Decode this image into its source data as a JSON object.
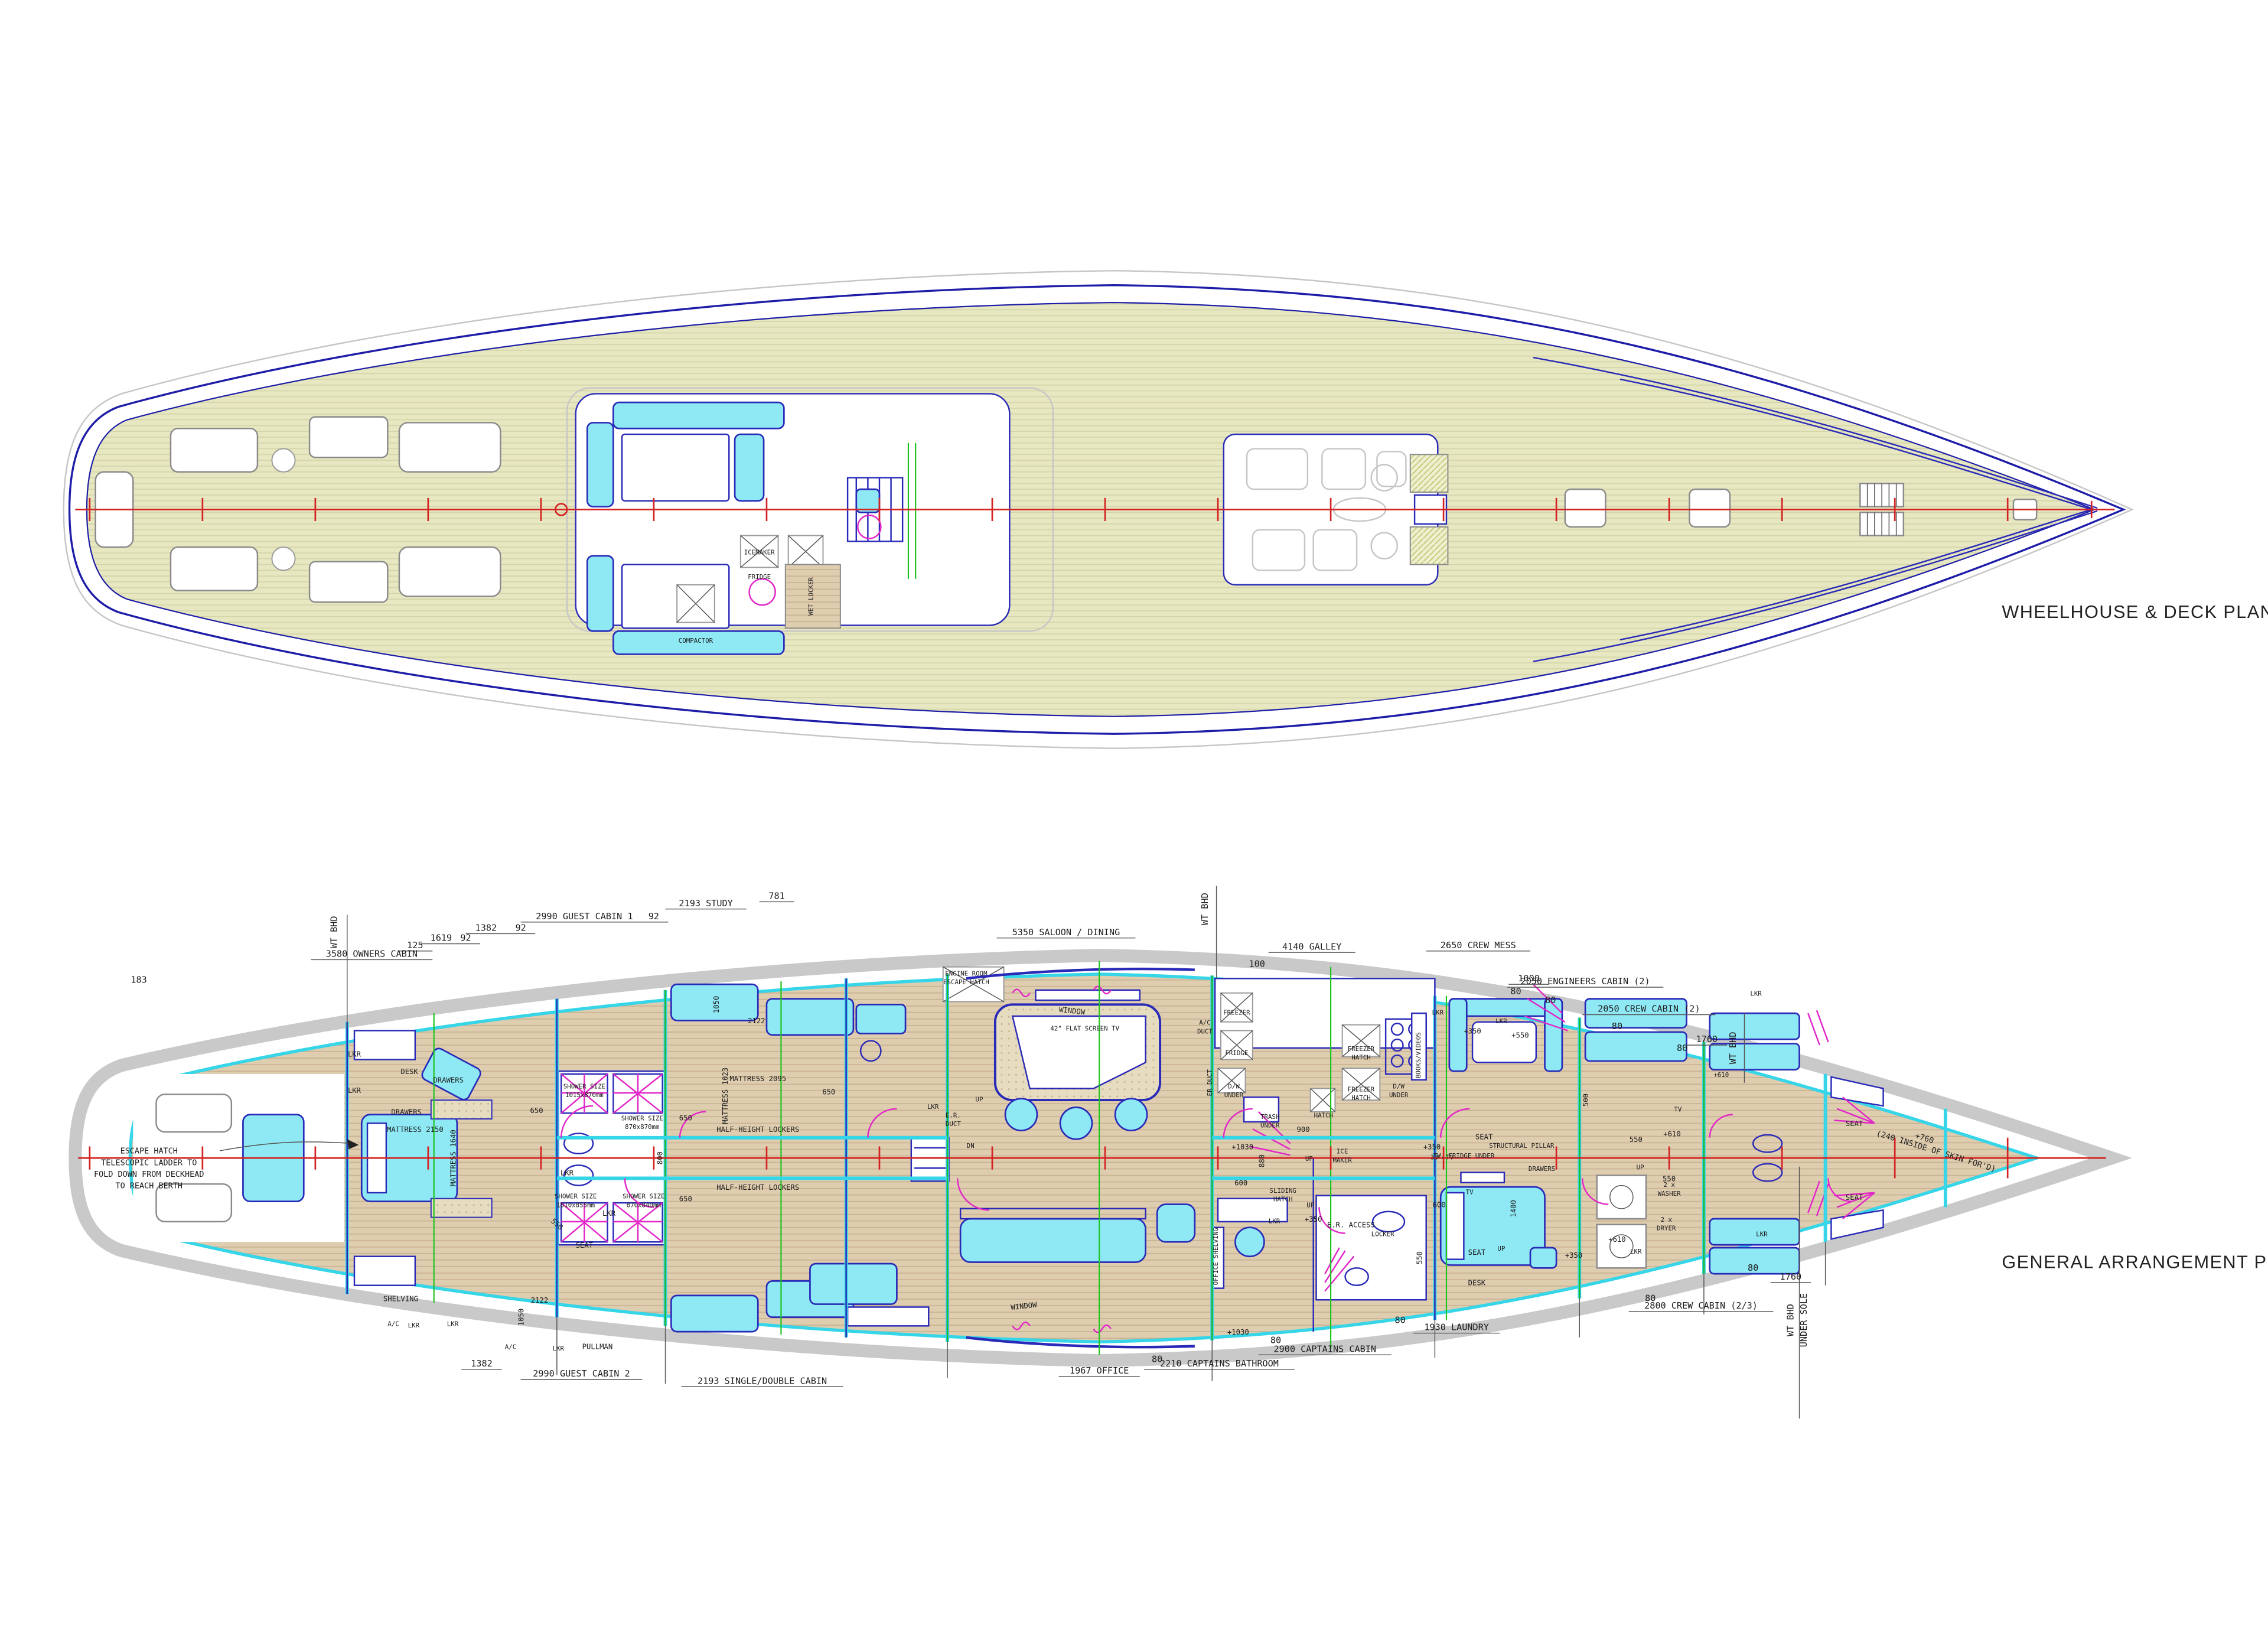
{
  "titles": {
    "deck": "WHEELHOUSE & DECK PLAN",
    "ga": "GENERAL ARRANGEMENT PLAN"
  },
  "colors": {
    "hull_outline": "#1d1da8",
    "ga_outline": "#3a3a3a",
    "deck_teak": "#e7e8c2",
    "cabin_sole": "#dfcdb0",
    "upholstery_cyan": "#8ee9f4",
    "wall_cyan": "#36d5e8",
    "door_magenta": "#e226c8",
    "frame_green": "#1ec41e",
    "centerline_red": "#d42222"
  },
  "deck": {
    "icemaker": "ICEMAKER",
    "fridge": "FRIDGE",
    "compactor": "COMPACTOR",
    "wet_locker": "WET LOCKER"
  },
  "ga": {
    "top": {
      "wt1": "WT BHD",
      "d183": "183",
      "owners": "3580 OWNERS CABIN",
      "d125": "125",
      "d1619": "1619",
      "d92a": "92",
      "d1382": "1382",
      "d92b": "92",
      "guest1": "2990 GUEST CABIN 1",
      "d92c": "92",
      "study": "2193 STUDY",
      "d781": "781",
      "saloon": "5350 SALOON / DINING",
      "wt2": "WT BHD",
      "galley": "4140 GALLEY",
      "d100": "100",
      "crewmess": "2650 CREW MESS",
      "d1000": "1000",
      "d80a": "80",
      "eng": "2050 ENGINEERS CABIN (2)",
      "d80b": "80",
      "crewcab": "2050 CREW CABIN (2)",
      "d80c": "80",
      "d1760": "1760",
      "d80d": "80",
      "wt3": "WT BHD"
    },
    "bottom": {
      "d1382": "1382",
      "guest2": "2990 GUEST CABIN 2",
      "single": "2193 SINGLE/DOUBLE CABIN",
      "office": "1967 OFFICE",
      "d80a": "80",
      "capbath": "2210 CAPTAINS BATHROOM",
      "d80b": "80",
      "capcabin": "2900 CAPTAINS CABIN",
      "d80c": "80",
      "laundry": "1930 LAUNDRY",
      "d80d": "80",
      "crew23": "2800 CREW CABIN (2/3)",
      "d80e": "80",
      "d1760": "1760",
      "wt": "WT BHD",
      "undersole": "UNDER SOLE"
    },
    "notes": {
      "esc1": "ESCAPE HATCH",
      "esc2": "TELESCOPIC LADDER TO",
      "esc3": "FOLD DOWN FROM DECKHEAD",
      "esc4": "TO REACH BERTH",
      "bow1": "+760",
      "bow2": "(240 INSIDE OF SKIN FOR'D)"
    },
    "rooms": {
      "lkr": "LKR",
      "ac": "A/C",
      "seat": "SEAT",
      "up": "UP",
      "dn": "DN",
      "desk": "DESK",
      "drawers": "DRAWERS",
      "window": "WINDOW",
      "shelving": "SHELVING",
      "pullman": "PULLMAN",
      "mat2150": "MATTRESS 2150",
      "mat1640": "MATTRESS 1640",
      "mat2095": "MATTRESS 2095",
      "mat1023": "MATTRESS 1023",
      "half_lockers": "HALF-HEIGHT LOCKERS",
      "shower": "SHOWER SIZE",
      "sh1": "1015x870mm",
      "sh2": "870x870mm",
      "sh3": "1010x855mm",
      "sh4": "870x840mm",
      "d650": "650",
      "d800": "800",
      "d550": "550",
      "p550": "+550",
      "d500": "500",
      "d600": "600",
      "d900": "900",
      "d880": "880",
      "d1400": "1400",
      "d1050": "1050",
      "d2122": "2122",
      "p350": "+350",
      "p610": "+610",
      "p1030": "+1030",
      "p760": "+760",
      "er_room": "ENGINE ROOM",
      "er_hatch": "ESCAPE HATCH",
      "tv42": "42\" FLAT SCREEN TV",
      "ac2": "A/C",
      "duct": "DUCT",
      "erduct": "ER DUCT",
      "er": "E.R.",
      "freezer": "FREEZER",
      "fridge": "FRIDGE",
      "dw": "D/W",
      "under": "UNDER",
      "trash": "TRASH",
      "hatch": "HATCH",
      "books": "BOOKS/VIDEOS",
      "ice": "ICE",
      "maker": "MAKER",
      "tv33": "33\" TV",
      "sliding": "SLIDING",
      "er_access": "E.R. ACCESS",
      "locker": "LOCKER",
      "office_shelving": "OFFICE SHELVING",
      "struct": "STRUCTURAL PILLAR",
      "tvfridge": "TV, FRIDGE UNDER",
      "tv": "TV",
      "x2": "2 x",
      "washer": "WASHER",
      "dryer": "DRYER"
    }
  }
}
